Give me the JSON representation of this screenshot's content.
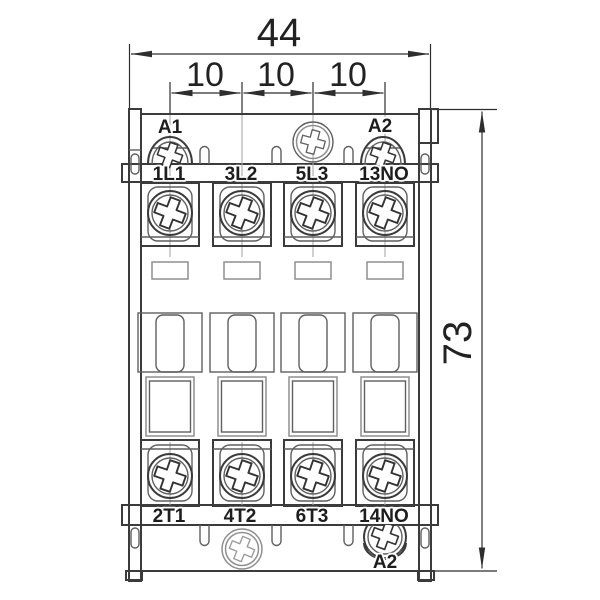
{
  "dims": {
    "width": "44",
    "p1": "10",
    "p2": "10",
    "p3": "10",
    "height": "73"
  },
  "labels": {
    "a1": "A1",
    "a2_top": "A2",
    "a2_bottom": "A2",
    "top_row": [
      "1L1",
      "3L2",
      "5L3",
      "13NO"
    ],
    "bottom_row": [
      "2T1",
      "4T2",
      "6T3",
      "14NO"
    ]
  },
  "colors": {
    "line": "#3b3b3b",
    "centerline": "#aaaaaa",
    "dim_text": "#222222",
    "background": "#ffffff"
  }
}
